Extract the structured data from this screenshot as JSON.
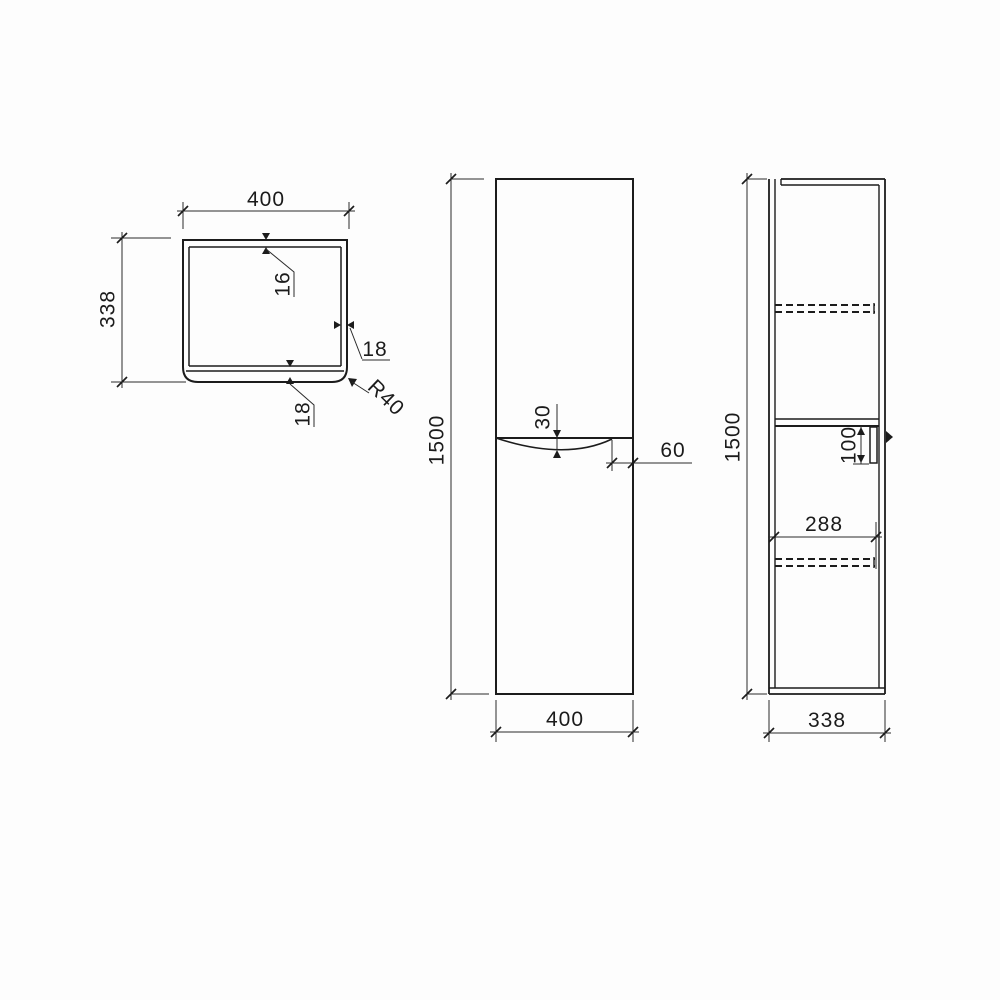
{
  "views": {
    "top": {
      "width": "400",
      "depth": "338",
      "top_panel_thickness": "16",
      "side_panel_thickness": "18",
      "front_panel_thickness": "18",
      "corner_radius": "R40"
    },
    "front": {
      "height": "1500",
      "width": "400",
      "recess_depth": "30",
      "recess_offset": "60"
    },
    "side": {
      "height": "1500",
      "depth": "338",
      "handle_length": "100",
      "interior_depth": "288"
    }
  }
}
